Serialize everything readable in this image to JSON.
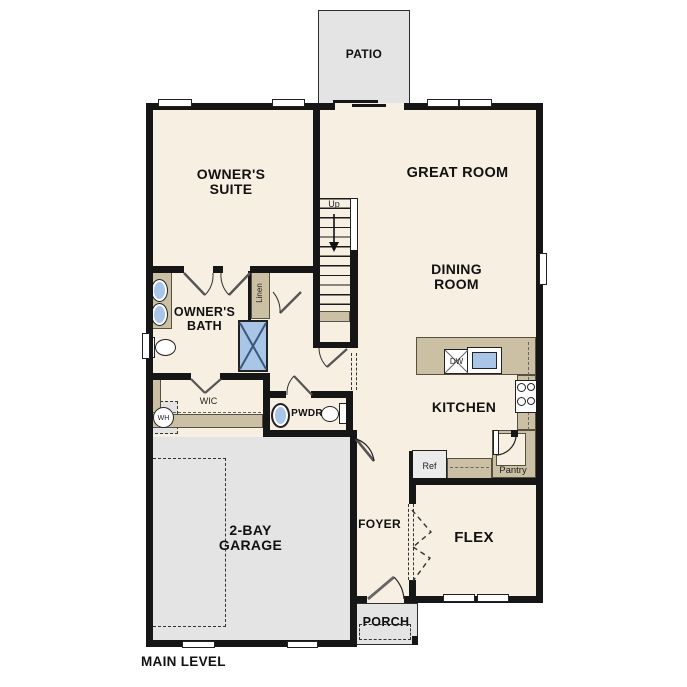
{
  "plan_title": "MAIN LEVEL",
  "colors": {
    "floor": "#f7efe2",
    "outdoor": "#e4e4e4",
    "counter": "#cbbfa4",
    "fixture_blue": "#a9c6e8",
    "wall": "#161616"
  },
  "rooms": {
    "patio": "PATIO",
    "owners_suite_1": "OWNER'S",
    "owners_suite_2": "SUITE",
    "great_room": "GREAT ROOM",
    "dining_1": "DINING",
    "dining_2": "ROOM",
    "owners_bath_1": "OWNER'S",
    "owners_bath_2": "BATH",
    "wic": "WIC",
    "pwdr": "PWDR",
    "kitchen": "KITCHEN",
    "garage_1": "2-BAY",
    "garage_2": "GARAGE",
    "foyer": "FOYER",
    "flex": "FLEX",
    "porch": "PORCH"
  },
  "annotations": {
    "up": "Up",
    "linen": "Linen",
    "dw": "DW",
    "ref": "Ref",
    "pantry": "Pantry",
    "wh": "WH"
  }
}
